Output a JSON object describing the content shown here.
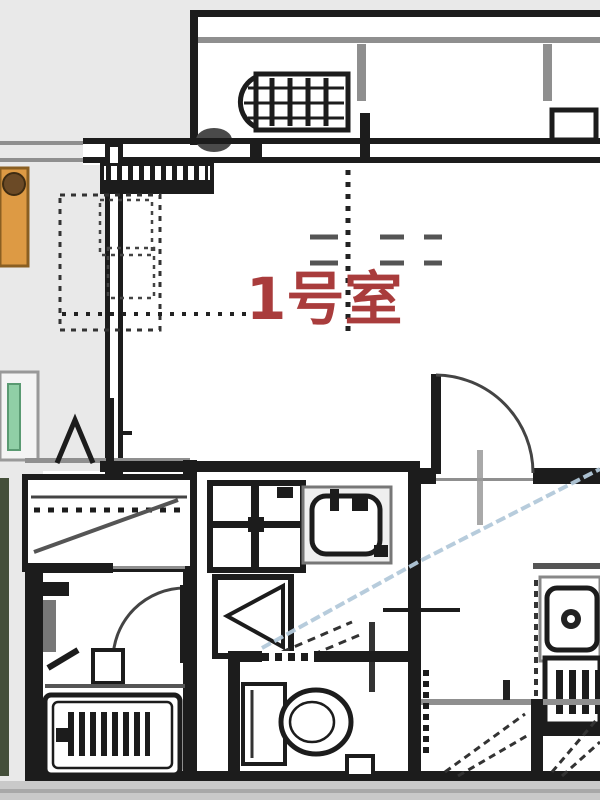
{
  "floor_plan": {
    "room_label": "1号室",
    "colors": {
      "label_red": "#a93c3c",
      "wall": "#1c1c1c",
      "outside_gray": "#e9e9e9",
      "mid_gray": "#8f8f8f",
      "heater_orange": "#dd9a44",
      "heater_orange_border": "#8a5f22",
      "plant_light_green": "#90cfa6",
      "plant_dark_green": "#444f3a",
      "section_blue": "#b3c9da",
      "bottom_band": "#c9c9c9"
    },
    "fixtures": {
      "balcony_unit": "water-heater",
      "bath": "bathtub",
      "wc": "toilet",
      "sink": "kitchen-sink",
      "stove": "gas-stove",
      "basin": "washbasin",
      "laundry": "washing-machine-space",
      "front_door": "entrance-door",
      "bath_door": "bathroom-door"
    }
  }
}
